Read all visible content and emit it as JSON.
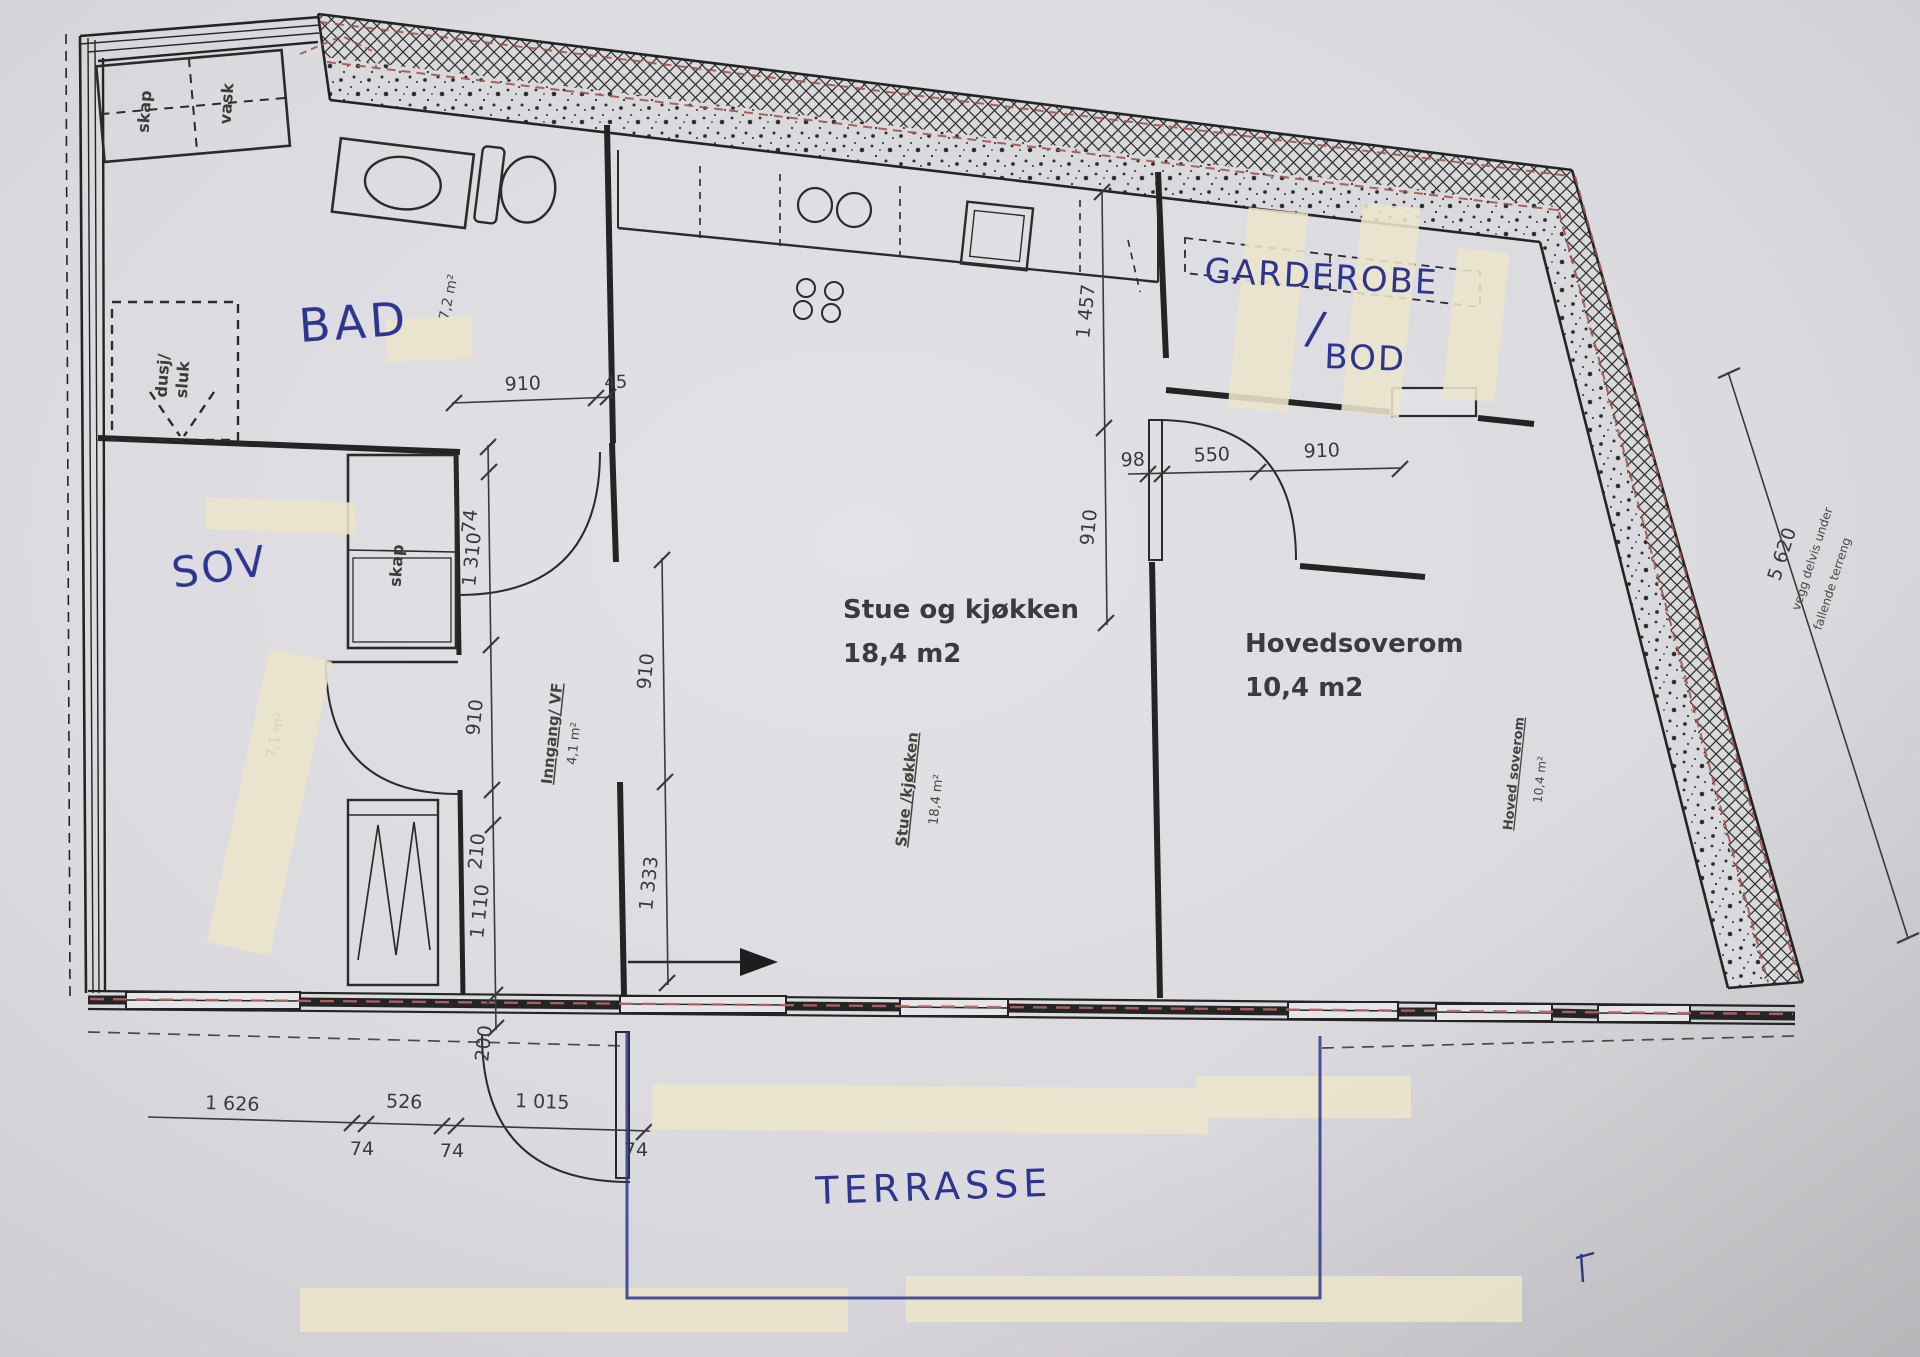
{
  "plan": {
    "rooms": {
      "stue": {
        "name": "Stue og kjøkken",
        "area": "18,4 m2"
      },
      "hovedsoverom": {
        "name": "Hovedsoverom",
        "area": "10,4 m2"
      },
      "stue_stamp": {
        "name": "Stue /kjøkken",
        "area": "18,4 m²"
      },
      "hovedsoverom_stamp": {
        "name": "Hoved soverom",
        "area": "10,4 m²"
      },
      "inngang_stamp": {
        "name": "Inngang/ VF",
        "area": "4,1 m²"
      },
      "bad_area": "7,2 m²",
      "sov_area": "7,1 m²"
    },
    "fixtures": {
      "skap": "skap",
      "vask": "vask",
      "dusj_line1": "dusj/",
      "dusj_line2": "sluk",
      "sov_skap": "skap"
    },
    "handwritten": {
      "bad": "BAD",
      "sov": "SOV",
      "garderobe": "GARDEROBE",
      "slash": "/",
      "bod": "BOD",
      "terrasse": "TERRASSE"
    },
    "dims": {
      "bad_door": "910",
      "bad_frame": "45",
      "left_chain": [
        "74",
        "1 310",
        "910",
        "210",
        "1 110",
        "200"
      ],
      "mid_chain": [
        "910",
        "1 333"
      ],
      "kitchen_chain": [
        "1 457",
        "910"
      ],
      "bedroom_chain": [
        "98",
        "550",
        "910"
      ],
      "bottom_chain": [
        "1 626",
        "526",
        "1 015"
      ],
      "bottom_frames": [
        "74",
        "74",
        "74"
      ],
      "right_total": "5 620"
    },
    "notes": {
      "wall_note_1": "vegg delvis under",
      "wall_note_2": "fallende terreng"
    },
    "colors": {
      "ink": "#2e3590",
      "red_dash": "#a3554d",
      "paper": "#dcdbdf"
    }
  }
}
